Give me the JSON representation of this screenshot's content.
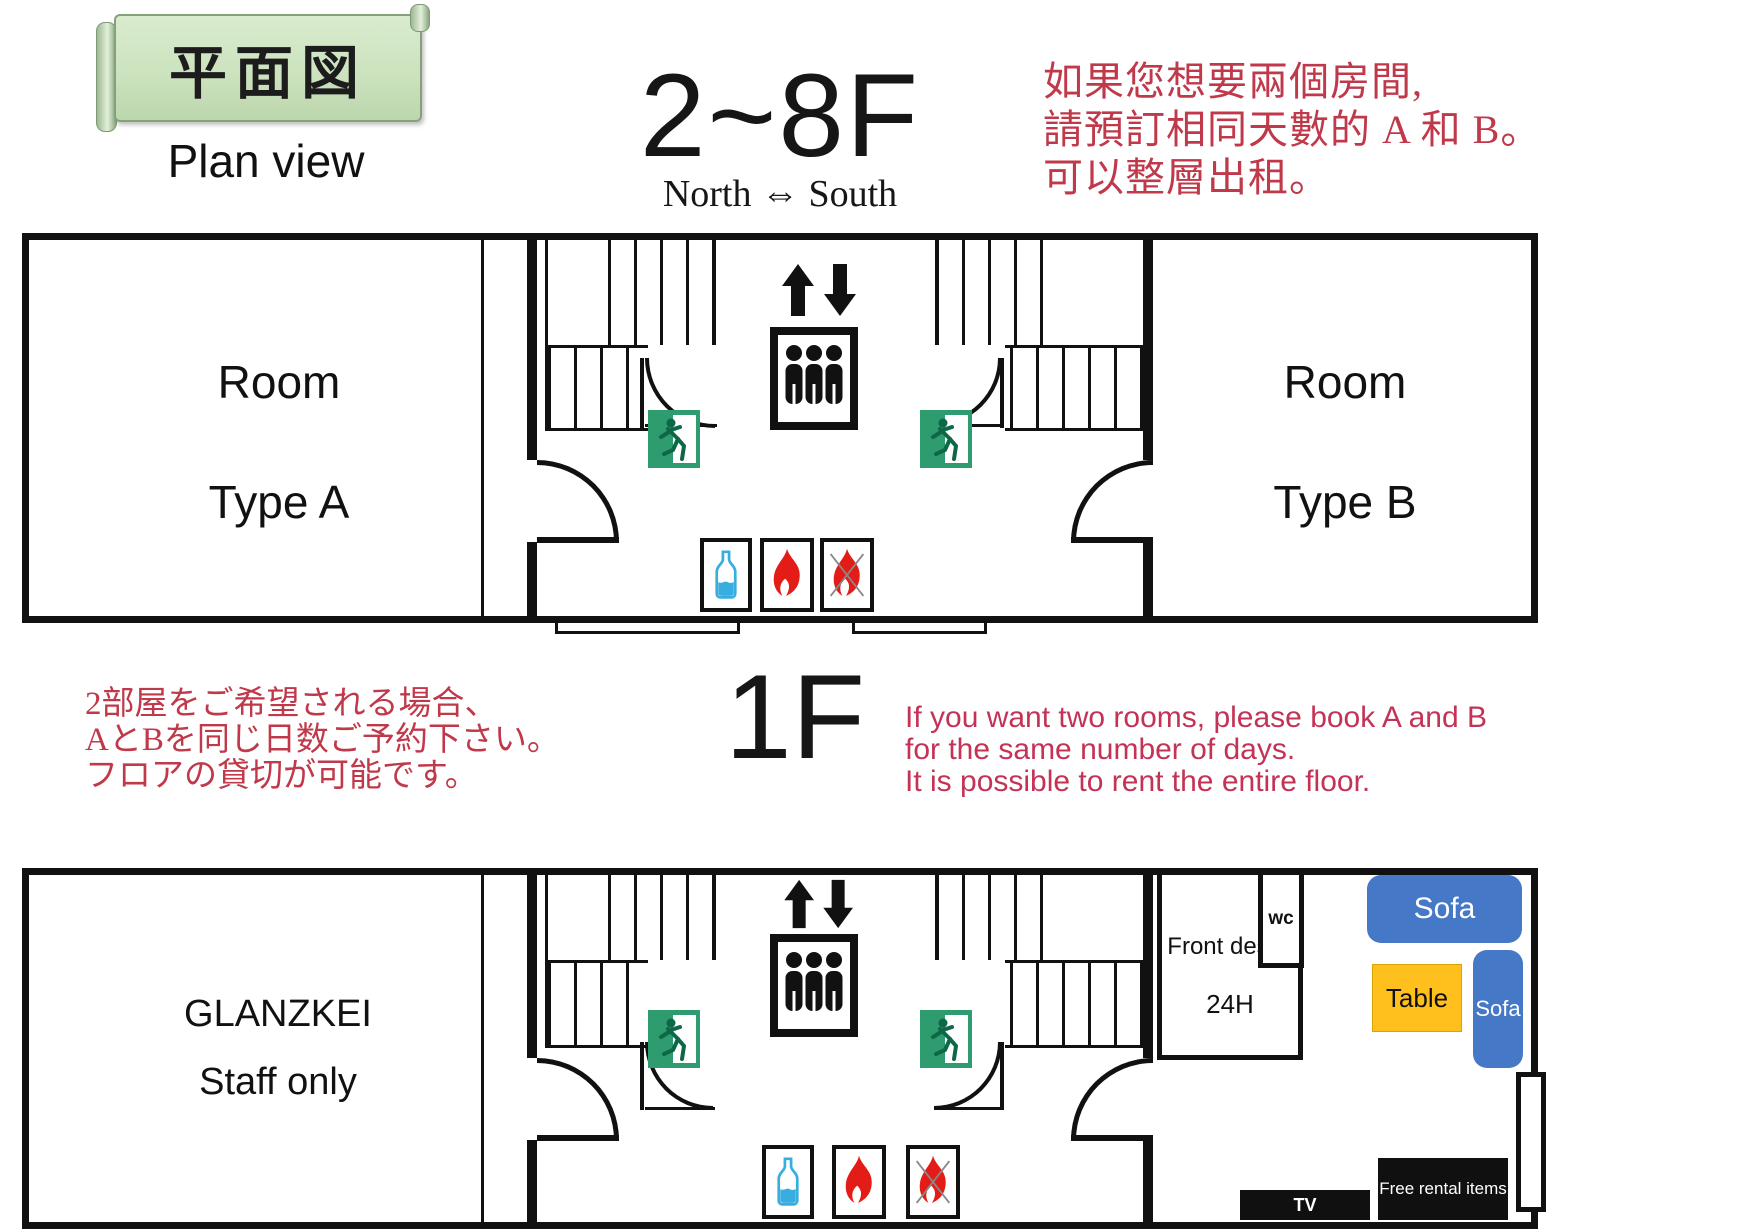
{
  "banner": {
    "title": "平面図",
    "subtitle": "Plan view"
  },
  "upper_floor": {
    "title": "2~8F",
    "direction": "North ⇔ South",
    "room_a": {
      "line1": "Room",
      "line2": "Type A"
    },
    "room_b": {
      "line1": "Room",
      "line2": "Type B"
    },
    "note_zh": {
      "line1": "如果您想要兩個房間,",
      "line2": "請預訂相同天數的 A 和 B。",
      "line3": "可以整層出租。"
    }
  },
  "lower_floor": {
    "title": "1F",
    "note_jp": {
      "line1": "2部屋をご希望される場合、",
      "line2": "AとBを同じ日数ご予約下さい。",
      "line3": "フロアの貸切が可能です。"
    },
    "note_en": {
      "line1": "If you want two rooms, please book A and B",
      "line2": "for the same number of days.",
      "line3": "It is possible to rent the entire floor."
    },
    "staff_room": {
      "line1": "GLANZKEI",
      "line2": "Staff only"
    },
    "front_desk": {
      "line1": "Front desk",
      "line2": "24H"
    },
    "wc_label": "wc",
    "sofa_top_label": "Sofa",
    "sofa_side_label": "Sofa",
    "table_label": "Table",
    "tv_label": "TV",
    "free_rental_label": "Free rental items"
  },
  "colors": {
    "wall_black": "#111111",
    "accent_red_serif": "#c0394a",
    "accent_red_sans": "#c43355",
    "exit_green": "#2e9c6e",
    "sofa_blue": "#4678c8",
    "table_yellow": "#ffc01e",
    "bottle_blue": "#38ade0",
    "flame_red": "#e41c17",
    "banner_green": "#cde4c0"
  }
}
